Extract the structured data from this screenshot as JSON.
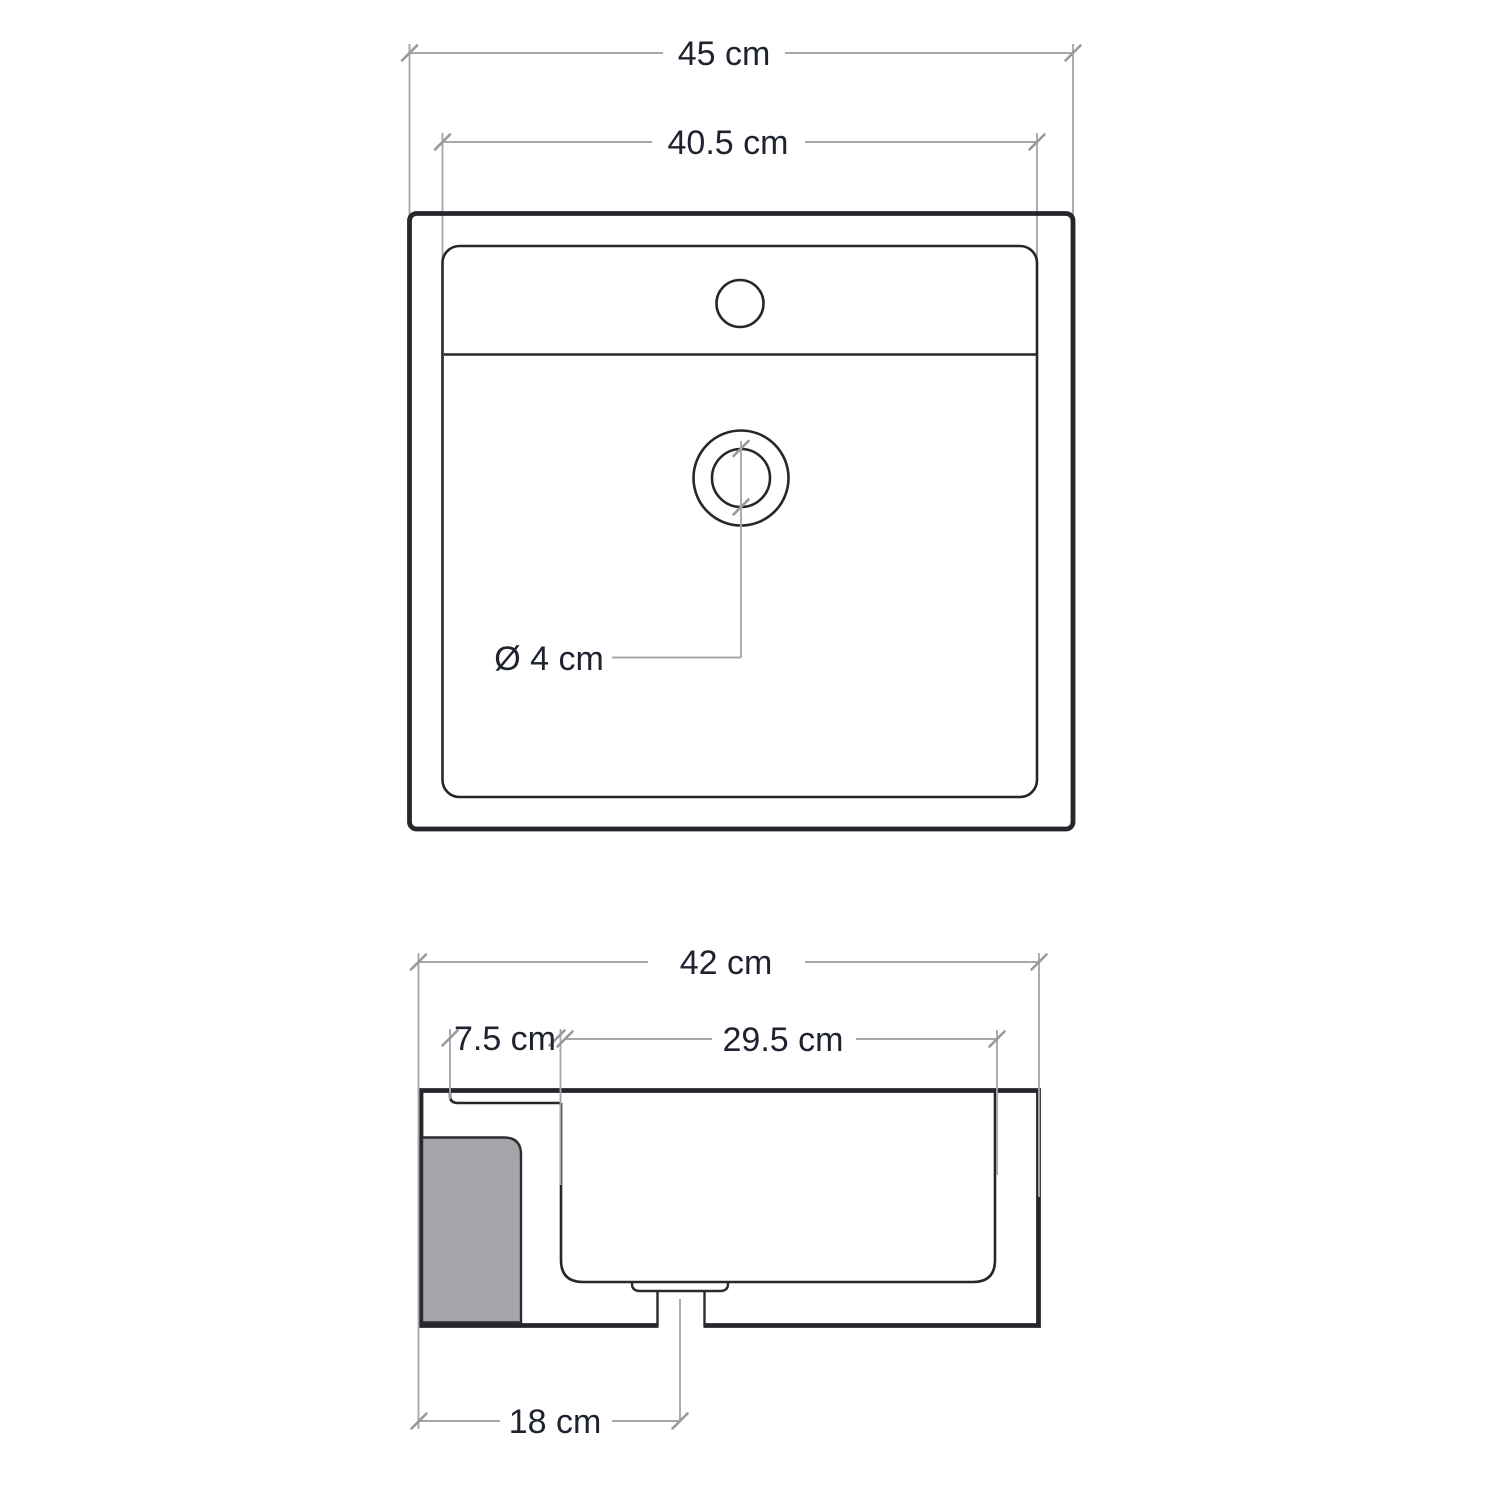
{
  "diagram": {
    "kind": "washbasin dimensional drawing, two orthographic views",
    "units": "cm",
    "colors": {
      "background": "#ffffff",
      "outline_ink": "#26262c",
      "dimension_gray": "#a6a8ab",
      "pedestal_fill_gray": "#a4a5a8",
      "label_text": "#1f2330"
    },
    "dimensions": {
      "top_view": [
        {
          "name": "overall_width",
          "label": "45 cm"
        },
        {
          "name": "inner_basin_width",
          "label": "40.5 cm"
        },
        {
          "name": "drain_hole_diameter",
          "label": "Ø 4 cm"
        }
      ],
      "side_view": [
        {
          "name": "overall_depth",
          "label": "42 cm"
        },
        {
          "name": "rear_deck_depth",
          "label": "7.5 cm"
        },
        {
          "name": "basin_inner_depth",
          "label": "29.5 cm"
        },
        {
          "name": "drain_offset_from_edge",
          "label": "18 cm"
        }
      ]
    }
  }
}
